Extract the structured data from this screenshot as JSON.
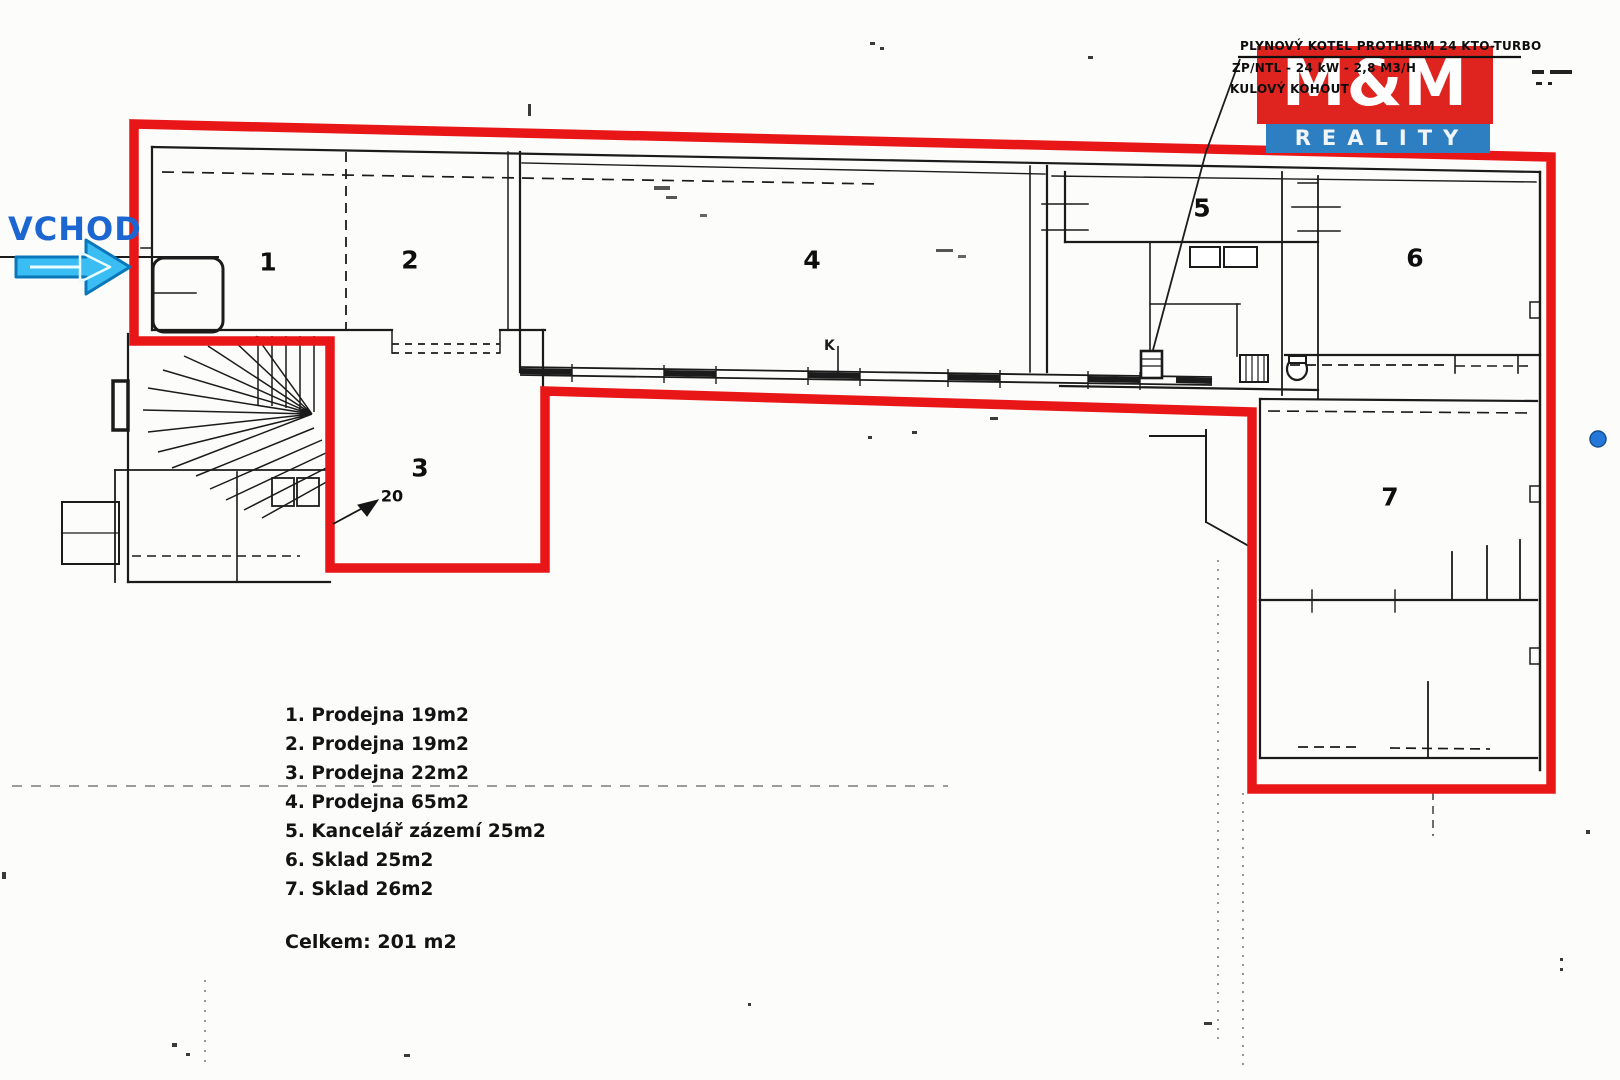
{
  "page": {
    "background": "#fcfcfb"
  },
  "logo": {
    "top": "M&M",
    "bottom": "REALITY",
    "red": "#df241f",
    "blue": "#2e7fc2"
  },
  "annotation": {
    "line1": "PLYNOVÝ KOTEL PROTHERM 24 KTO-TURBO",
    "line2": "ZP/NTL - 24 kW - 2,8 M3/H",
    "line3": "KULOVÝ KOHOUT"
  },
  "entrance": {
    "label": "VCHOD",
    "color": "#1b66d0",
    "arrow_fill": "#39bdf2",
    "arrow_stroke": "#0a77bb"
  },
  "rooms": [
    {
      "number": "1"
    },
    {
      "number": "2"
    },
    {
      "number": "3"
    },
    {
      "number": "4"
    },
    {
      "number": "5"
    },
    {
      "number": "6"
    },
    {
      "number": "7"
    }
  ],
  "door_width_label": "20",
  "plan_marks": {
    "k": "K"
  },
  "legend": {
    "items": [
      "1. Prodejna 19m2",
      "2. Prodejna 19m2",
      "3. Prodejna 22m2",
      "4. Prodejna 65m2",
      "5. Kancelář zázemí 25m2",
      "6. Sklad 25m2",
      "7. Sklad 26m2"
    ],
    "total": "Celkem: 201 m2"
  },
  "colors": {
    "lease_outline_red": "#e81616",
    "wall_black": "#1b1b1b",
    "blue_dot": "#2277d8"
  }
}
